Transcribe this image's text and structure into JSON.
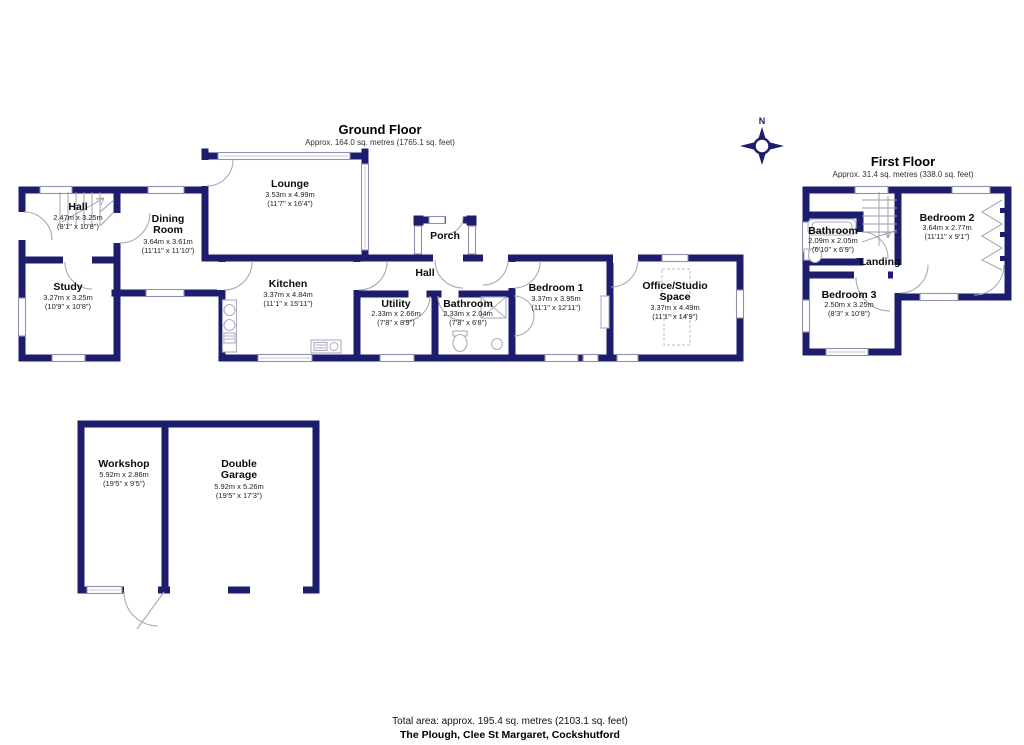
{
  "ground_floor": {
    "title": "Ground Floor",
    "subtitle": "Approx. 164.0 sq. metres (1765.1 sq. feet)",
    "rooms": {
      "hall": {
        "name": "Hall",
        "metric": "2.47m x 3.25m",
        "imperial": "(8'1\" x 10'8\")"
      },
      "dining": {
        "name1": "Dining",
        "name2": "Room",
        "metric": "3.64m x 3.61m",
        "imperial": "(11'11\" x 11'10\")"
      },
      "study": {
        "name": "Study",
        "metric": "3.27m x 3.25m",
        "imperial": "(10'9\" x 10'8\")"
      },
      "lounge": {
        "name": "Lounge",
        "metric": "3.53m x 4.99m",
        "imperial": "(11'7\" x 16'4\")"
      },
      "kitchen": {
        "name": "Kitchen",
        "metric": "3.37m x 4.84m",
        "imperial": "(11'1\" x 15'11\")"
      },
      "porch": {
        "name": "Porch"
      },
      "inner_hall": {
        "name": "Hall"
      },
      "utility": {
        "name": "Utility",
        "metric": "2.33m x 2.66m",
        "imperial": "(7'8\" x 8'9\")"
      },
      "bathroom": {
        "name": "Bathroom",
        "metric": "2.33m x 2.04m",
        "imperial": "(7'8\" x 6'8\")"
      },
      "bedroom1": {
        "name": "Bedroom 1",
        "metric": "3.37m x 3.95m",
        "imperial": "(11'1\" x 12'11\")"
      },
      "office": {
        "name1": "Office/Studio",
        "name2": "Space",
        "metric": "3.37m x 4.49m",
        "imperial": "(11'1\" x 14'9\")"
      }
    }
  },
  "first_floor": {
    "title": "First Floor",
    "subtitle": "Approx. 31.4 sq. metres (338.0 sq. feet)",
    "rooms": {
      "bathroom": {
        "name": "Bathroom",
        "metric": "2.09m x 2.05m",
        "imperial": "(6'10\" x 6'9\")"
      },
      "bedroom2": {
        "name": "Bedroom 2",
        "metric": "3.64m x 2.77m",
        "imperial": "(11'11\" x 9'1\")"
      },
      "landing": {
        "name": "Landing"
      },
      "bedroom3": {
        "name": "Bedroom 3",
        "metric": "2.50m x 3.25m",
        "imperial": "(8'3\" x 10'8\")"
      }
    }
  },
  "outbuilding": {
    "rooms": {
      "workshop": {
        "name": "Workshop",
        "metric": "5.92m x 2.86m",
        "imperial": "(19'5\" x 9'5\")"
      },
      "garage": {
        "name1": "Double",
        "name2": "Garage",
        "metric": "5.92m x 5.26m",
        "imperial": "(19'5\" x 17'3\")"
      }
    }
  },
  "compass": {
    "label": "N"
  },
  "footer": {
    "total_area": "Total area: approx. 195.4 sq. metres (2103.1 sq. feet)",
    "address": "The Plough, Clee St Margaret, Cockshutford"
  },
  "colors": {
    "wall": "#1d1d6e"
  }
}
